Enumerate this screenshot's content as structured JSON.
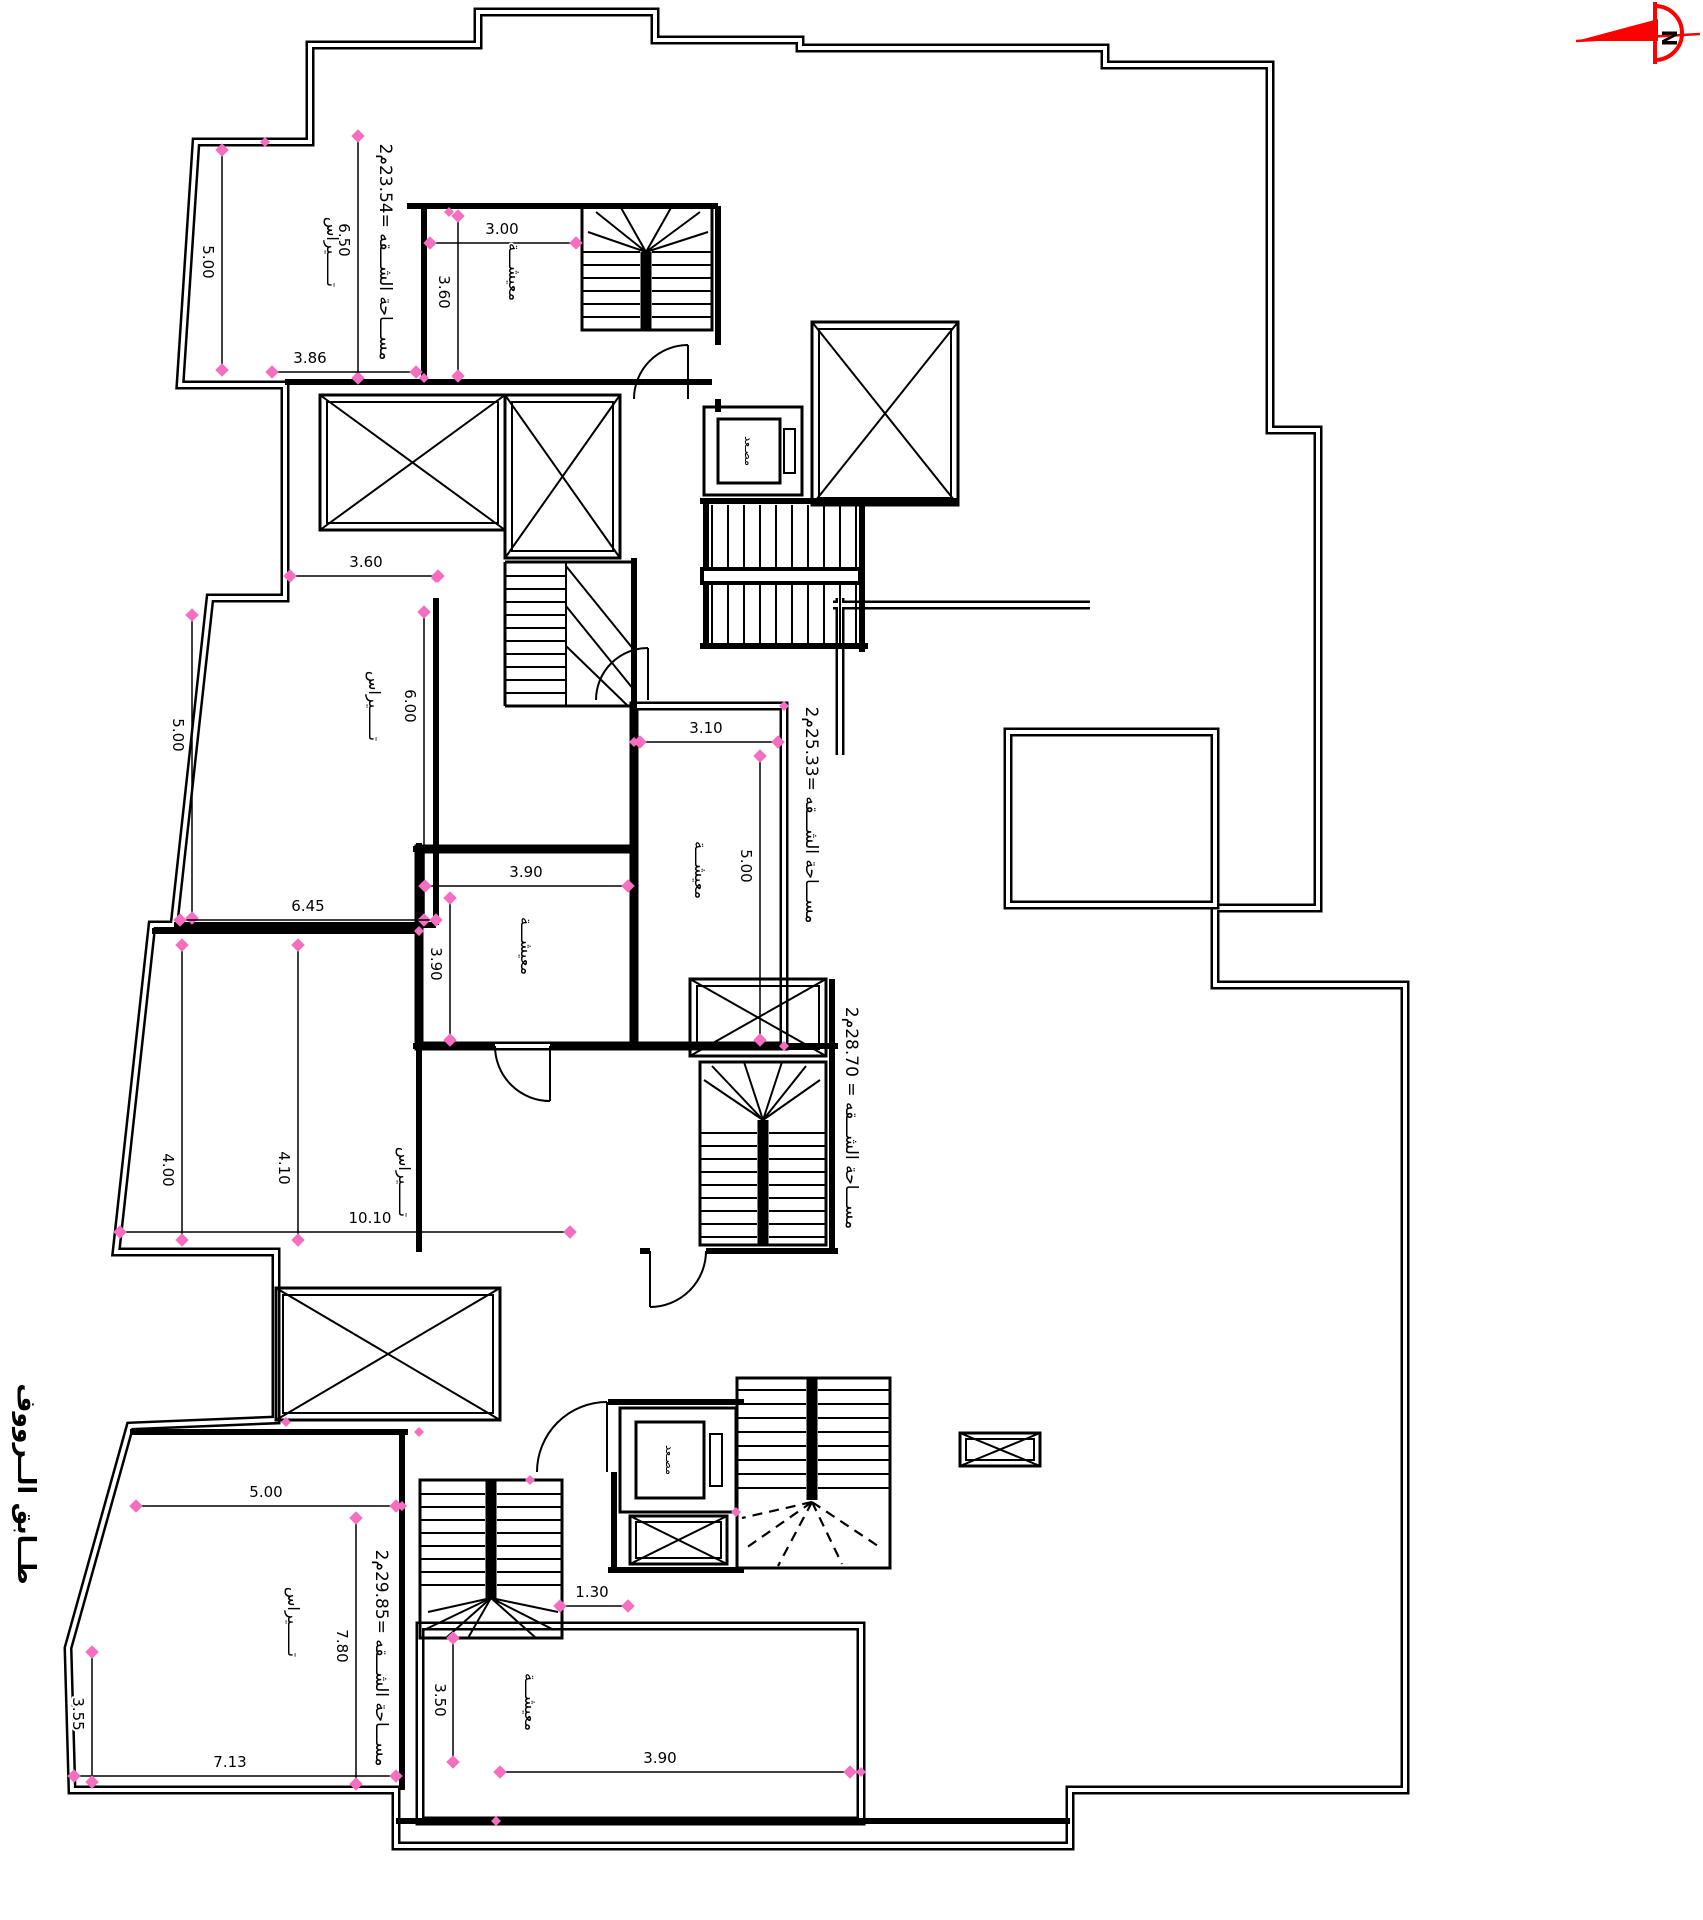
{
  "title": {
    "floor_label": "طــابق الــرووف"
  },
  "north_arrow": {
    "letter": "N",
    "arrow_color": "#ff0000",
    "letter_color": "#ee1ccf"
  },
  "area_labels": [
    {
      "apartment": "top",
      "text": "مســـاحة الشـــقه =23.54م2"
    },
    {
      "apartment": "middle",
      "text": "مســـاحة الشـــقه =25.33م2"
    },
    {
      "apartment": "third",
      "text": "مســـاحة الشـــقه = 28.70م2"
    },
    {
      "apartment": "bottom",
      "text": "مســـاحة الشـــقه =29.85م2"
    }
  ],
  "room_labels": {
    "terrace": "تــــــيراس",
    "living": "معيشـــة",
    "elevator": "مصـعد"
  },
  "dimensions": [
    {
      "v": "5.00"
    },
    {
      "v": "6.50"
    },
    {
      "v": "3.86"
    },
    {
      "v": "3.00"
    },
    {
      "v": "3.60"
    },
    {
      "v": "3.60"
    },
    {
      "v": "6.00"
    },
    {
      "v": "5.00"
    },
    {
      "v": "6.45"
    },
    {
      "v": "3.10"
    },
    {
      "v": "5.00"
    },
    {
      "v": "3.90"
    },
    {
      "v": "3.90"
    },
    {
      "v": "4.00"
    },
    {
      "v": "4.10"
    },
    {
      "v": "10.10"
    },
    {
      "v": "5.00"
    },
    {
      "v": "7.80"
    },
    {
      "v": "1.30"
    },
    {
      "v": "3.50"
    },
    {
      "v": "3.90"
    },
    {
      "v": "7.13"
    },
    {
      "v": "3.55"
    }
  ],
  "colors": {
    "line": "#000000",
    "marker": "#f56ec0",
    "background": "#ffffff"
  }
}
